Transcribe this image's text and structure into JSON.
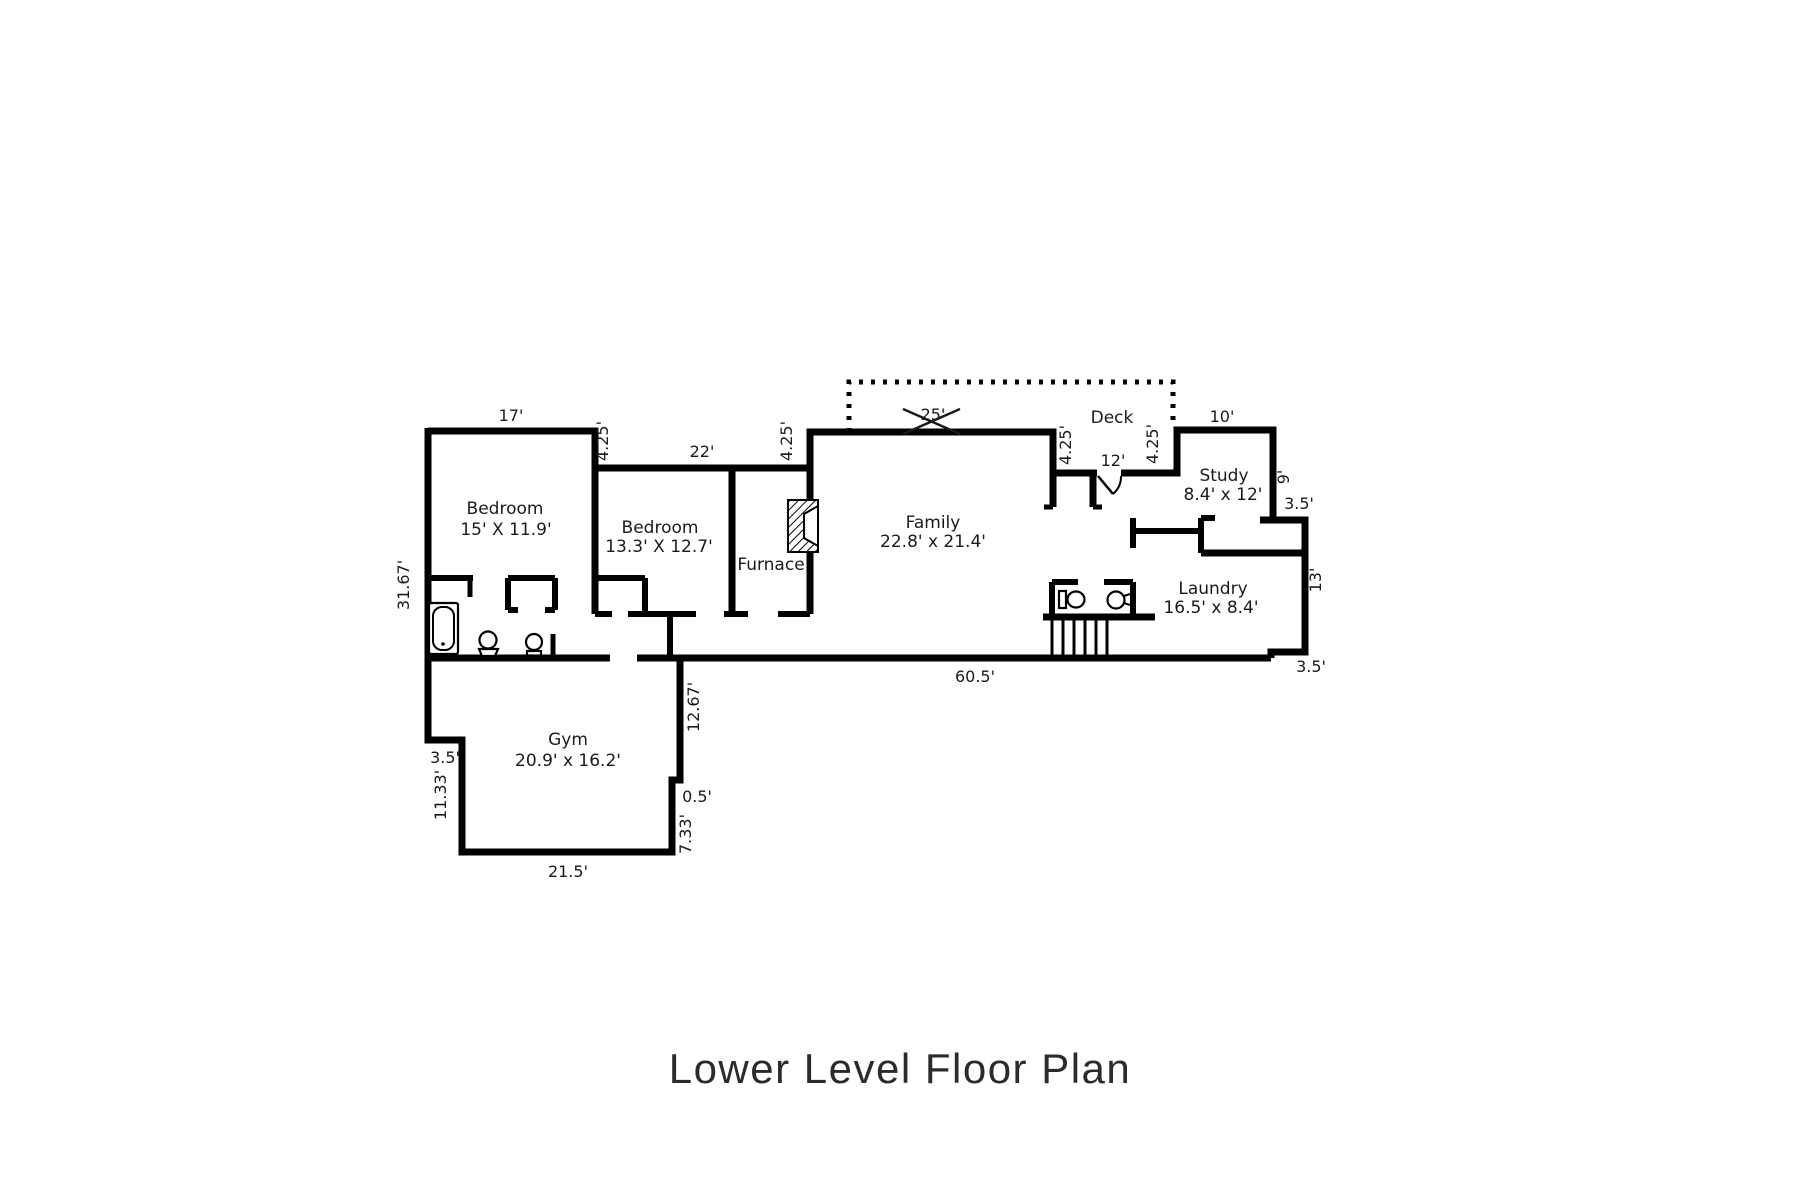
{
  "title": "Lower Level Floor Plan",
  "colors": {
    "wall": "#000000",
    "text": "#1a1a1a",
    "background": "#ffffff",
    "title": "#2b2b2b"
  },
  "rooms": [
    {
      "name": "Bedroom",
      "dims": "15' X 11.9'"
    },
    {
      "name": "Bedroom",
      "dims": "13.3' X 12.7'"
    },
    {
      "name": "Furnace",
      "dims": ""
    },
    {
      "name": "Family",
      "dims": "22.8' x 21.4'"
    },
    {
      "name": "Deck",
      "dims": ""
    },
    {
      "name": "Study",
      "dims": "8.4' x 12'"
    },
    {
      "name": "Laundry",
      "dims": "16.5' x 8.4'"
    },
    {
      "name": "Gym",
      "dims": "20.9' x 16.2'"
    }
  ],
  "dims": {
    "bed1_top": "17'",
    "step_a": "4.25'",
    "bed2_top": "22'",
    "step_b": "4.25'",
    "family_top": "25'",
    "notch_left": "4.25'",
    "notch_width": "12'",
    "notch_right": "4.25'",
    "study_top": "10'",
    "study_right": "9'",
    "study_jog": "3.5'",
    "right_wall": "13'",
    "bottom_right_jog": "3.5'",
    "bottom_main": "60.5'",
    "left_wall": "31.67'",
    "gym_left_jog": "3.5'",
    "gym_left_lower": "11.33'",
    "gym_bottom": "21.5'",
    "gym_right_lower": "7.33'",
    "gym_right_notch": "0.5'",
    "gym_right_upper": "12.67'"
  },
  "fixtures": [
    "bathtub",
    "pedestal-sink",
    "toilet",
    "powder-toilet",
    "powder-sink",
    "fireplace",
    "staircase",
    "deck-dashed-outline",
    "entry-door-swing",
    "dimension-cross-marks"
  ]
}
